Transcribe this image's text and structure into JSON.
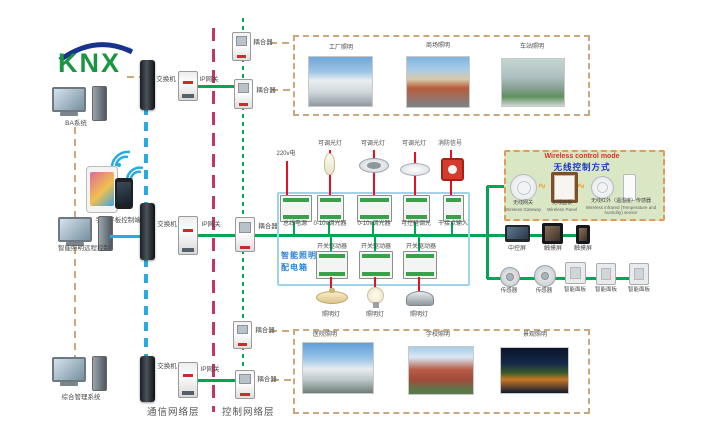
{
  "logo": {
    "text": "KNX",
    "reg": "®"
  },
  "left": {
    "pc1": "BA系统",
    "tablet": "手机平板控制端",
    "pc2": "智能照明远程控制",
    "pc3": "综合管理系统"
  },
  "net": {
    "switch": "交换机",
    "gateway": "IP网关",
    "coupler": "耦合器",
    "comm_layer": "通信网络层",
    "ctrl_layer": "控制网络层"
  },
  "box": {
    "title1": "智能照明",
    "title2": "配电箱",
    "power": "220v电",
    "row1": [
      "总线电源",
      "0-10v调光器",
      "0-10v调光器",
      "可控硅调光",
      "干接点输入"
    ],
    "row2": [
      "开关驱动器",
      "开关驱动器",
      "开关驱动器"
    ],
    "top_lamps": [
      "可调光灯",
      "可调光灯",
      "可调光灯",
      "消防信号"
    ],
    "bottom_lamps": [
      "照明灯",
      "照明灯",
      "照明灯"
    ]
  },
  "wireless": {
    "title_en": "Wireless control mode",
    "title_zh": "无线控制方式",
    "devices": [
      {
        "zh": "无线网关",
        "en": "Wireless Gateway"
      },
      {
        "zh": "无线面板",
        "en": "Wireless Panel"
      },
      {
        "zh": "无线红外（温湿度）传感器",
        "en": "Wireless infrared (Temperature and humidity) sensor"
      }
    ]
  },
  "right": {
    "screens": [
      "中控屏",
      "触摸屏",
      "触摸屏"
    ],
    "sensors": [
      "传感器",
      "传感器",
      "智能面板",
      "智能面板",
      "智能面板"
    ]
  },
  "photos_top": [
    {
      "label": "工厂照明"
    },
    {
      "label": "商场照明"
    },
    {
      "label": "车站照明"
    }
  ],
  "photos_bottom": [
    {
      "label": "医院照明"
    },
    {
      "label": "学校照明"
    },
    {
      "label": "景观照明"
    }
  ],
  "icons": {
    "signal": "∿"
  },
  "colors": {
    "comm_line": "#29aae1",
    "ctrl_line": "#00a651",
    "layer_divider": "#c0366b",
    "mgmt_line": "#c8a87c",
    "power_line": "#e81123",
    "wireless_bg": "#d9e7c4",
    "wireless_border": "#e09a5a"
  }
}
